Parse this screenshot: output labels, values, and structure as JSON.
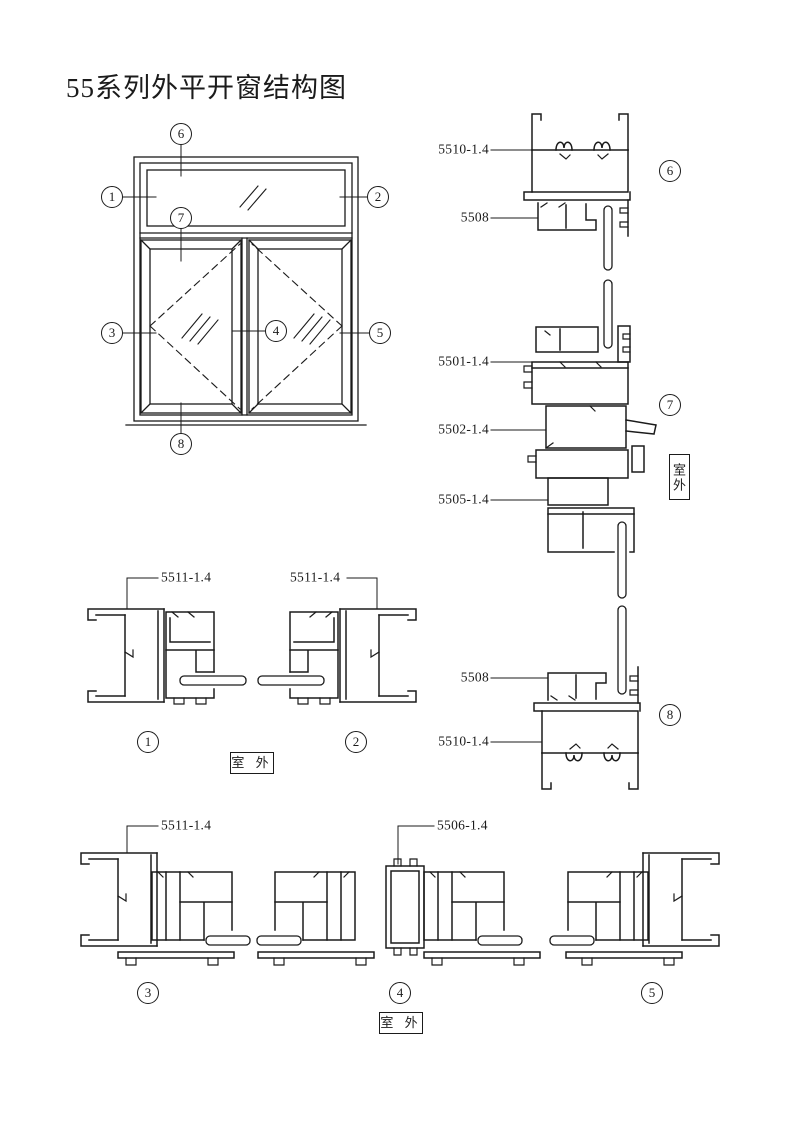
{
  "title": "55系列外平开窗结构图",
  "outdoor_horizontal": "室 外",
  "outdoor_vertical": "室外",
  "elevation": {
    "callouts": [
      "1",
      "2",
      "3",
      "4",
      "5",
      "6",
      "7",
      "8"
    ]
  },
  "sections": {
    "s1": {
      "number": "1",
      "label": "5511-1.4"
    },
    "s2": {
      "number": "2",
      "label": "5511-1.4"
    },
    "s3": {
      "number": "3",
      "label": "5511-1.4"
    },
    "s4": {
      "number": "4",
      "label": "5506-1.4"
    },
    "s5": {
      "number": "5"
    },
    "s6": {
      "number": "6",
      "labels": [
        "5510-1.4",
        "5508"
      ]
    },
    "s7": {
      "number": "7",
      "labels": [
        "5501-1.4",
        "5502-1.4",
        "5505-1.4"
      ]
    },
    "s8": {
      "number": "8",
      "labels": [
        "5508",
        "5510-1.4"
      ]
    }
  }
}
